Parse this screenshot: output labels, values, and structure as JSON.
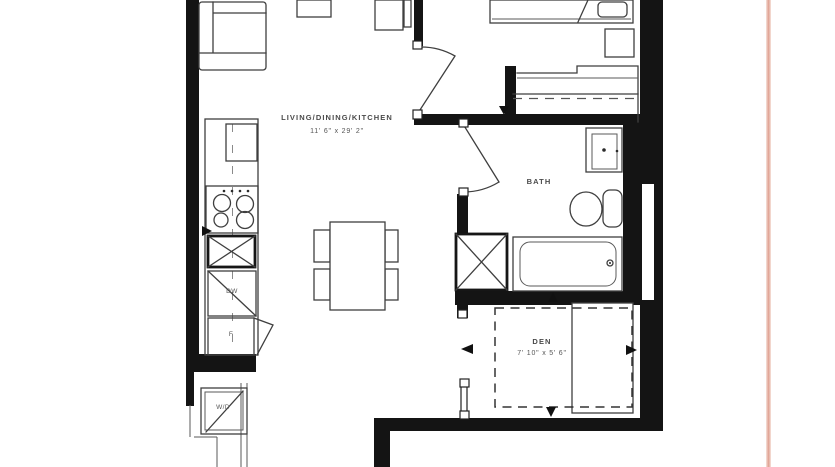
{
  "plan": {
    "rooms": {
      "living": {
        "label": "LIVING/DINING/KITCHEN",
        "dimensions": "11' 6\" x 29' 2\""
      },
      "bath": {
        "label": "BATH"
      },
      "den": {
        "label": "DEN",
        "dimensions": "7' 10\" x 5' 6\""
      }
    },
    "appliances": {
      "dishwasher": "DW",
      "fridge": "F",
      "washer_dryer": "W/D"
    },
    "colors": {
      "wall": "#141414",
      "line": "#3f3f3f",
      "label": "#4a4a4a",
      "page-edge": "#dfa091"
    }
  }
}
